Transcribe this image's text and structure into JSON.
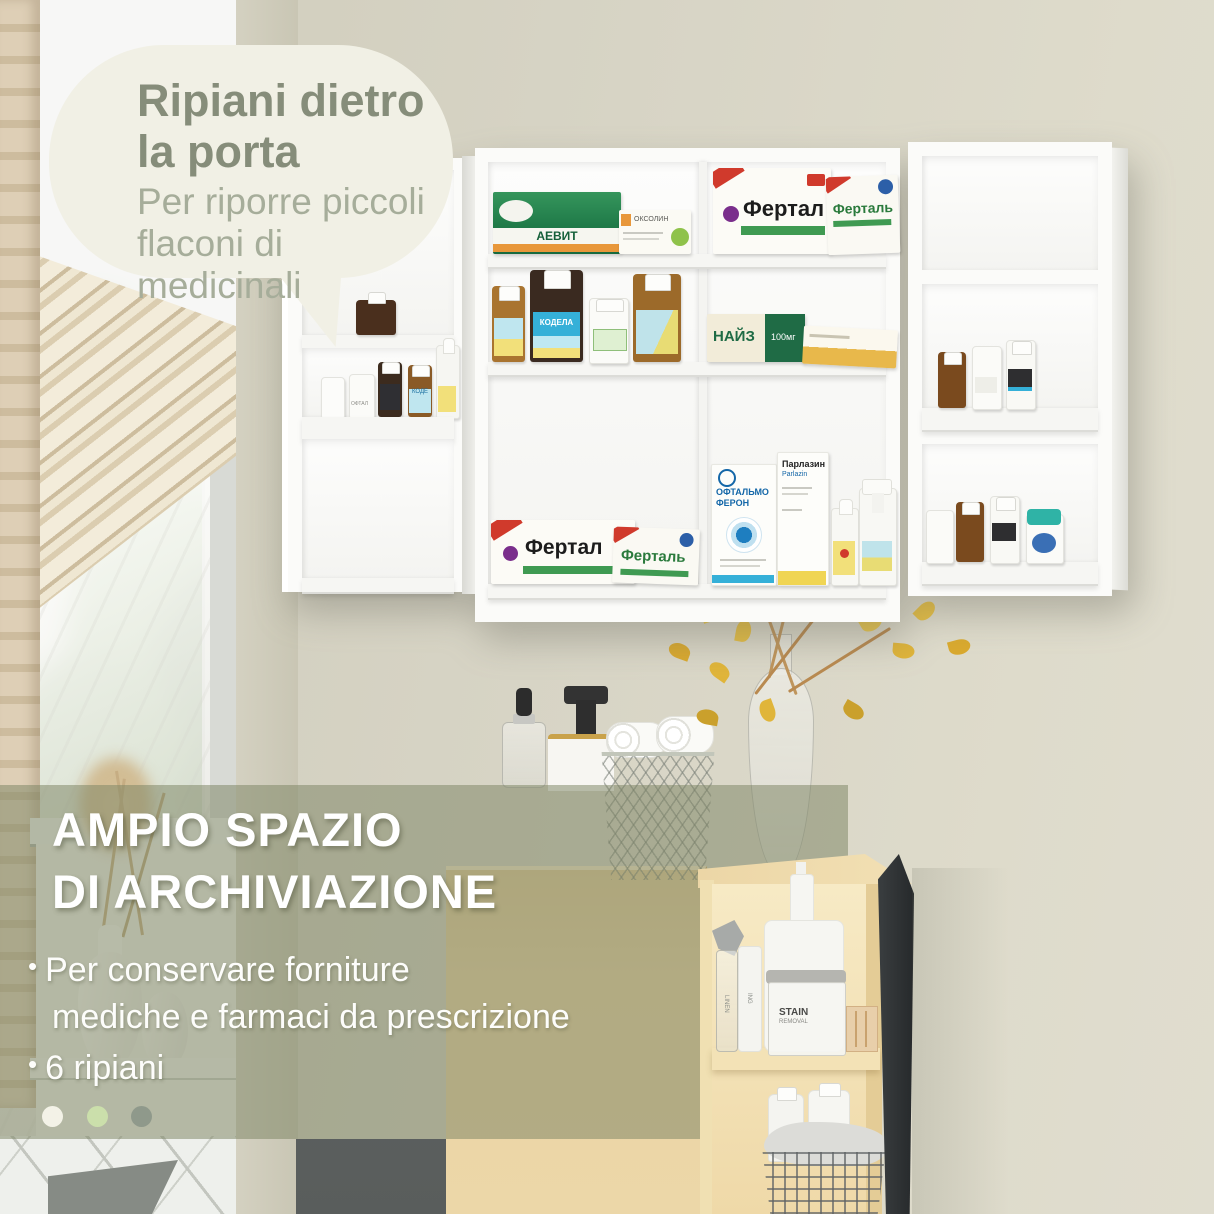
{
  "bubble": {
    "title_line1": "Ripiani dietro",
    "title_line2": "la porta",
    "body_line1": "Per riporre piccoli",
    "body_line2": "flaconi di medicinali",
    "bg_color": "#f1f0e5",
    "title_color": "#868d7a",
    "body_color": "#a6ad9a"
  },
  "overlay": {
    "title_line1": "AMPIO SPAZIO",
    "title_line2": "DI ARCHIVIAZIONE",
    "bullets": [
      {
        "line1": "Per conservare forniture",
        "line2": "mediche e farmaci da prescrizione"
      },
      {
        "line1": "6 ripiani",
        "line2": ""
      }
    ],
    "bg_color": "#7b8463",
    "text_color": "#ffffff",
    "dots": [
      {
        "color": "#f3f2e7"
      },
      {
        "color": "#cbdfab"
      },
      {
        "color": "#8f998b"
      }
    ]
  },
  "products": {
    "aevit": "АЕВИТ",
    "oxolin": "ОКСОЛИН",
    "fertal": "Фертал",
    "fertal2": "Ферталь",
    "nise": "НАЙЗ",
    "nise_dose": "100мг",
    "kodelak": "КОДЕЛА",
    "kodelak_sm": "КОДЕ",
    "oftal": "ОФТАЛ",
    "oftalmo1": "ОФТАЛЬМО",
    "oftalmo2": "ФЕРОН",
    "parlazin_ru": "Парлазин",
    "parlazin_en": "Parlazin",
    "linen": "LINEN",
    "ing": "ING",
    "stain1": "STAIN",
    "stain2": "REMOVAL"
  }
}
